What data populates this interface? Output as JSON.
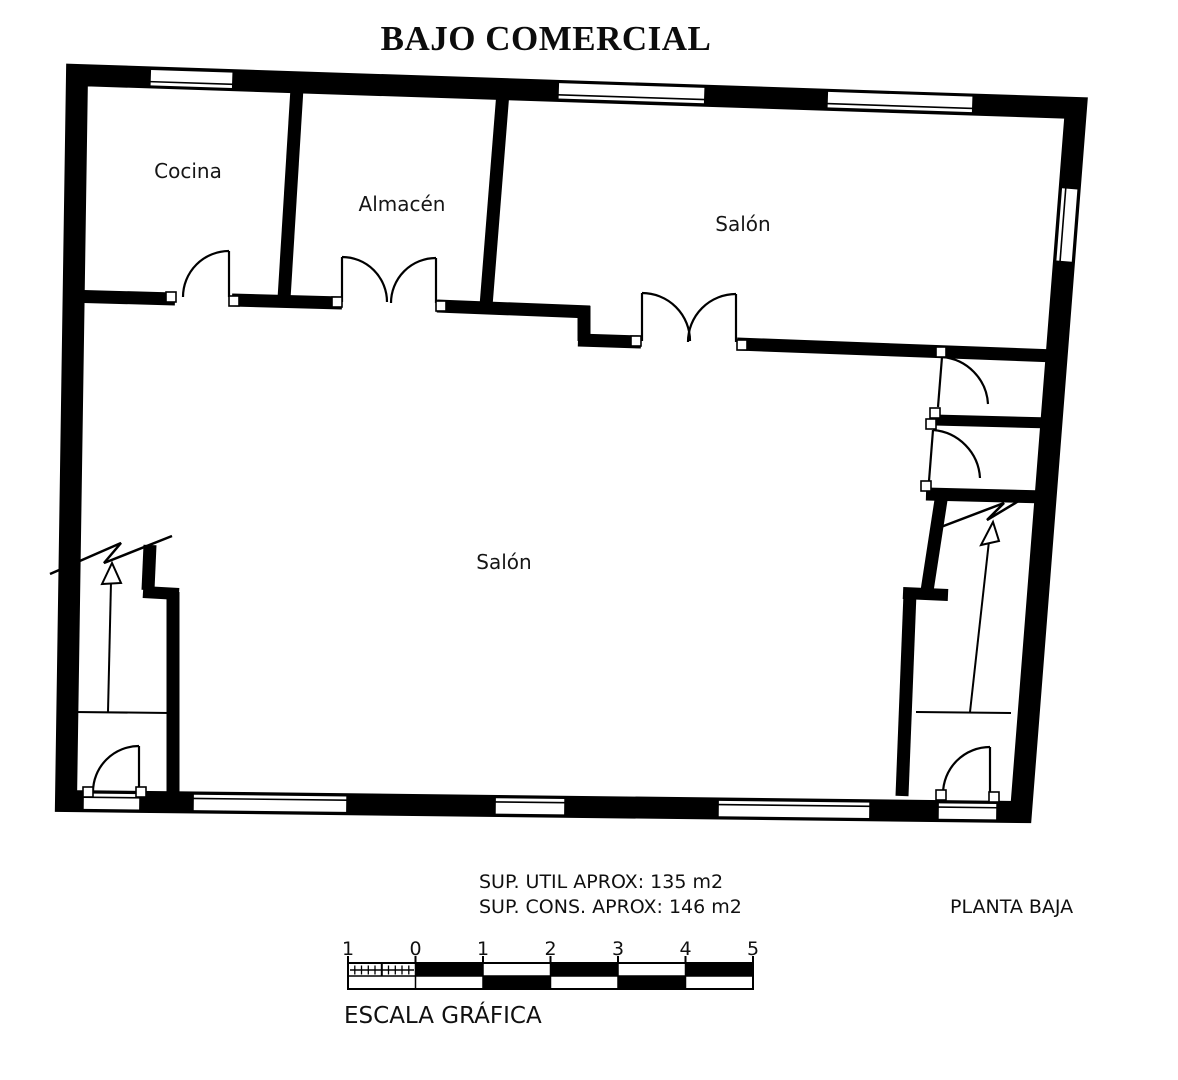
{
  "title": "BAJO COMERCIAL",
  "plan": {
    "rooms": [
      {
        "id": "cocina",
        "label": "Cocina"
      },
      {
        "id": "almacen",
        "label": "Almacén"
      },
      {
        "id": "salon-top",
        "label": "Salón"
      },
      {
        "id": "salon-bottom",
        "label": "Salón"
      }
    ]
  },
  "notes": {
    "sup_util": "SUP. UTIL APROX: 135 m2",
    "sup_cons": "SUP. CONS. APROX: 146 m2",
    "plan_name": "PLANTA BAJA"
  },
  "scalebar": {
    "labels": [
      "1",
      "0",
      "1",
      "2",
      "3",
      "4",
      "5"
    ],
    "caption": "ESCALA GRÁFICA"
  },
  "colors": {
    "wall": "#000000",
    "background": "#ffffff",
    "text": "#111111"
  }
}
